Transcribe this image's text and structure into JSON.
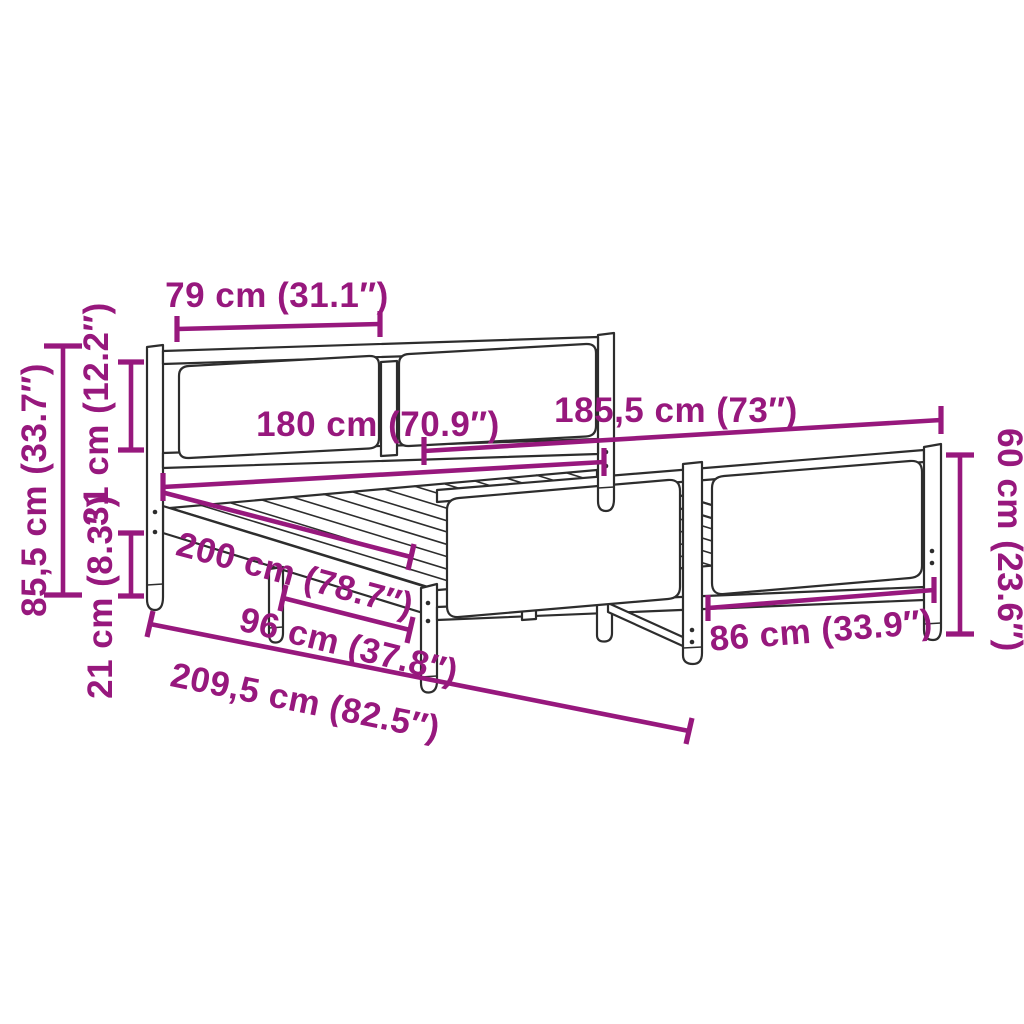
{
  "diagram": {
    "subject": "bed frame with headboard and footboard dimension diagram",
    "background_color": "#ffffff",
    "dimension_color": "#97187D",
    "outline_color": "#2d2d2d",
    "units": "cm / inches"
  },
  "dimensions": {
    "headboard_panel_width": "79 cm (31.1″)",
    "headboard_top_section_height": "31 cm (12.2″)",
    "headboard_total_height": "85,5 cm (33.7″)",
    "side_rail_height": "21 cm (8.3″)",
    "mattress_width": "180 cm (70.9″)",
    "overall_width": "185,5 cm (73″)",
    "mattress_length": "200 cm (78.7″)",
    "leg_spacing": "96 cm (37.8″)",
    "overall_length": "209,5 cm (82.5″)",
    "footboard_panel_width": "86 cm (33.9″)",
    "footboard_height": "60 cm (23.6″)"
  }
}
